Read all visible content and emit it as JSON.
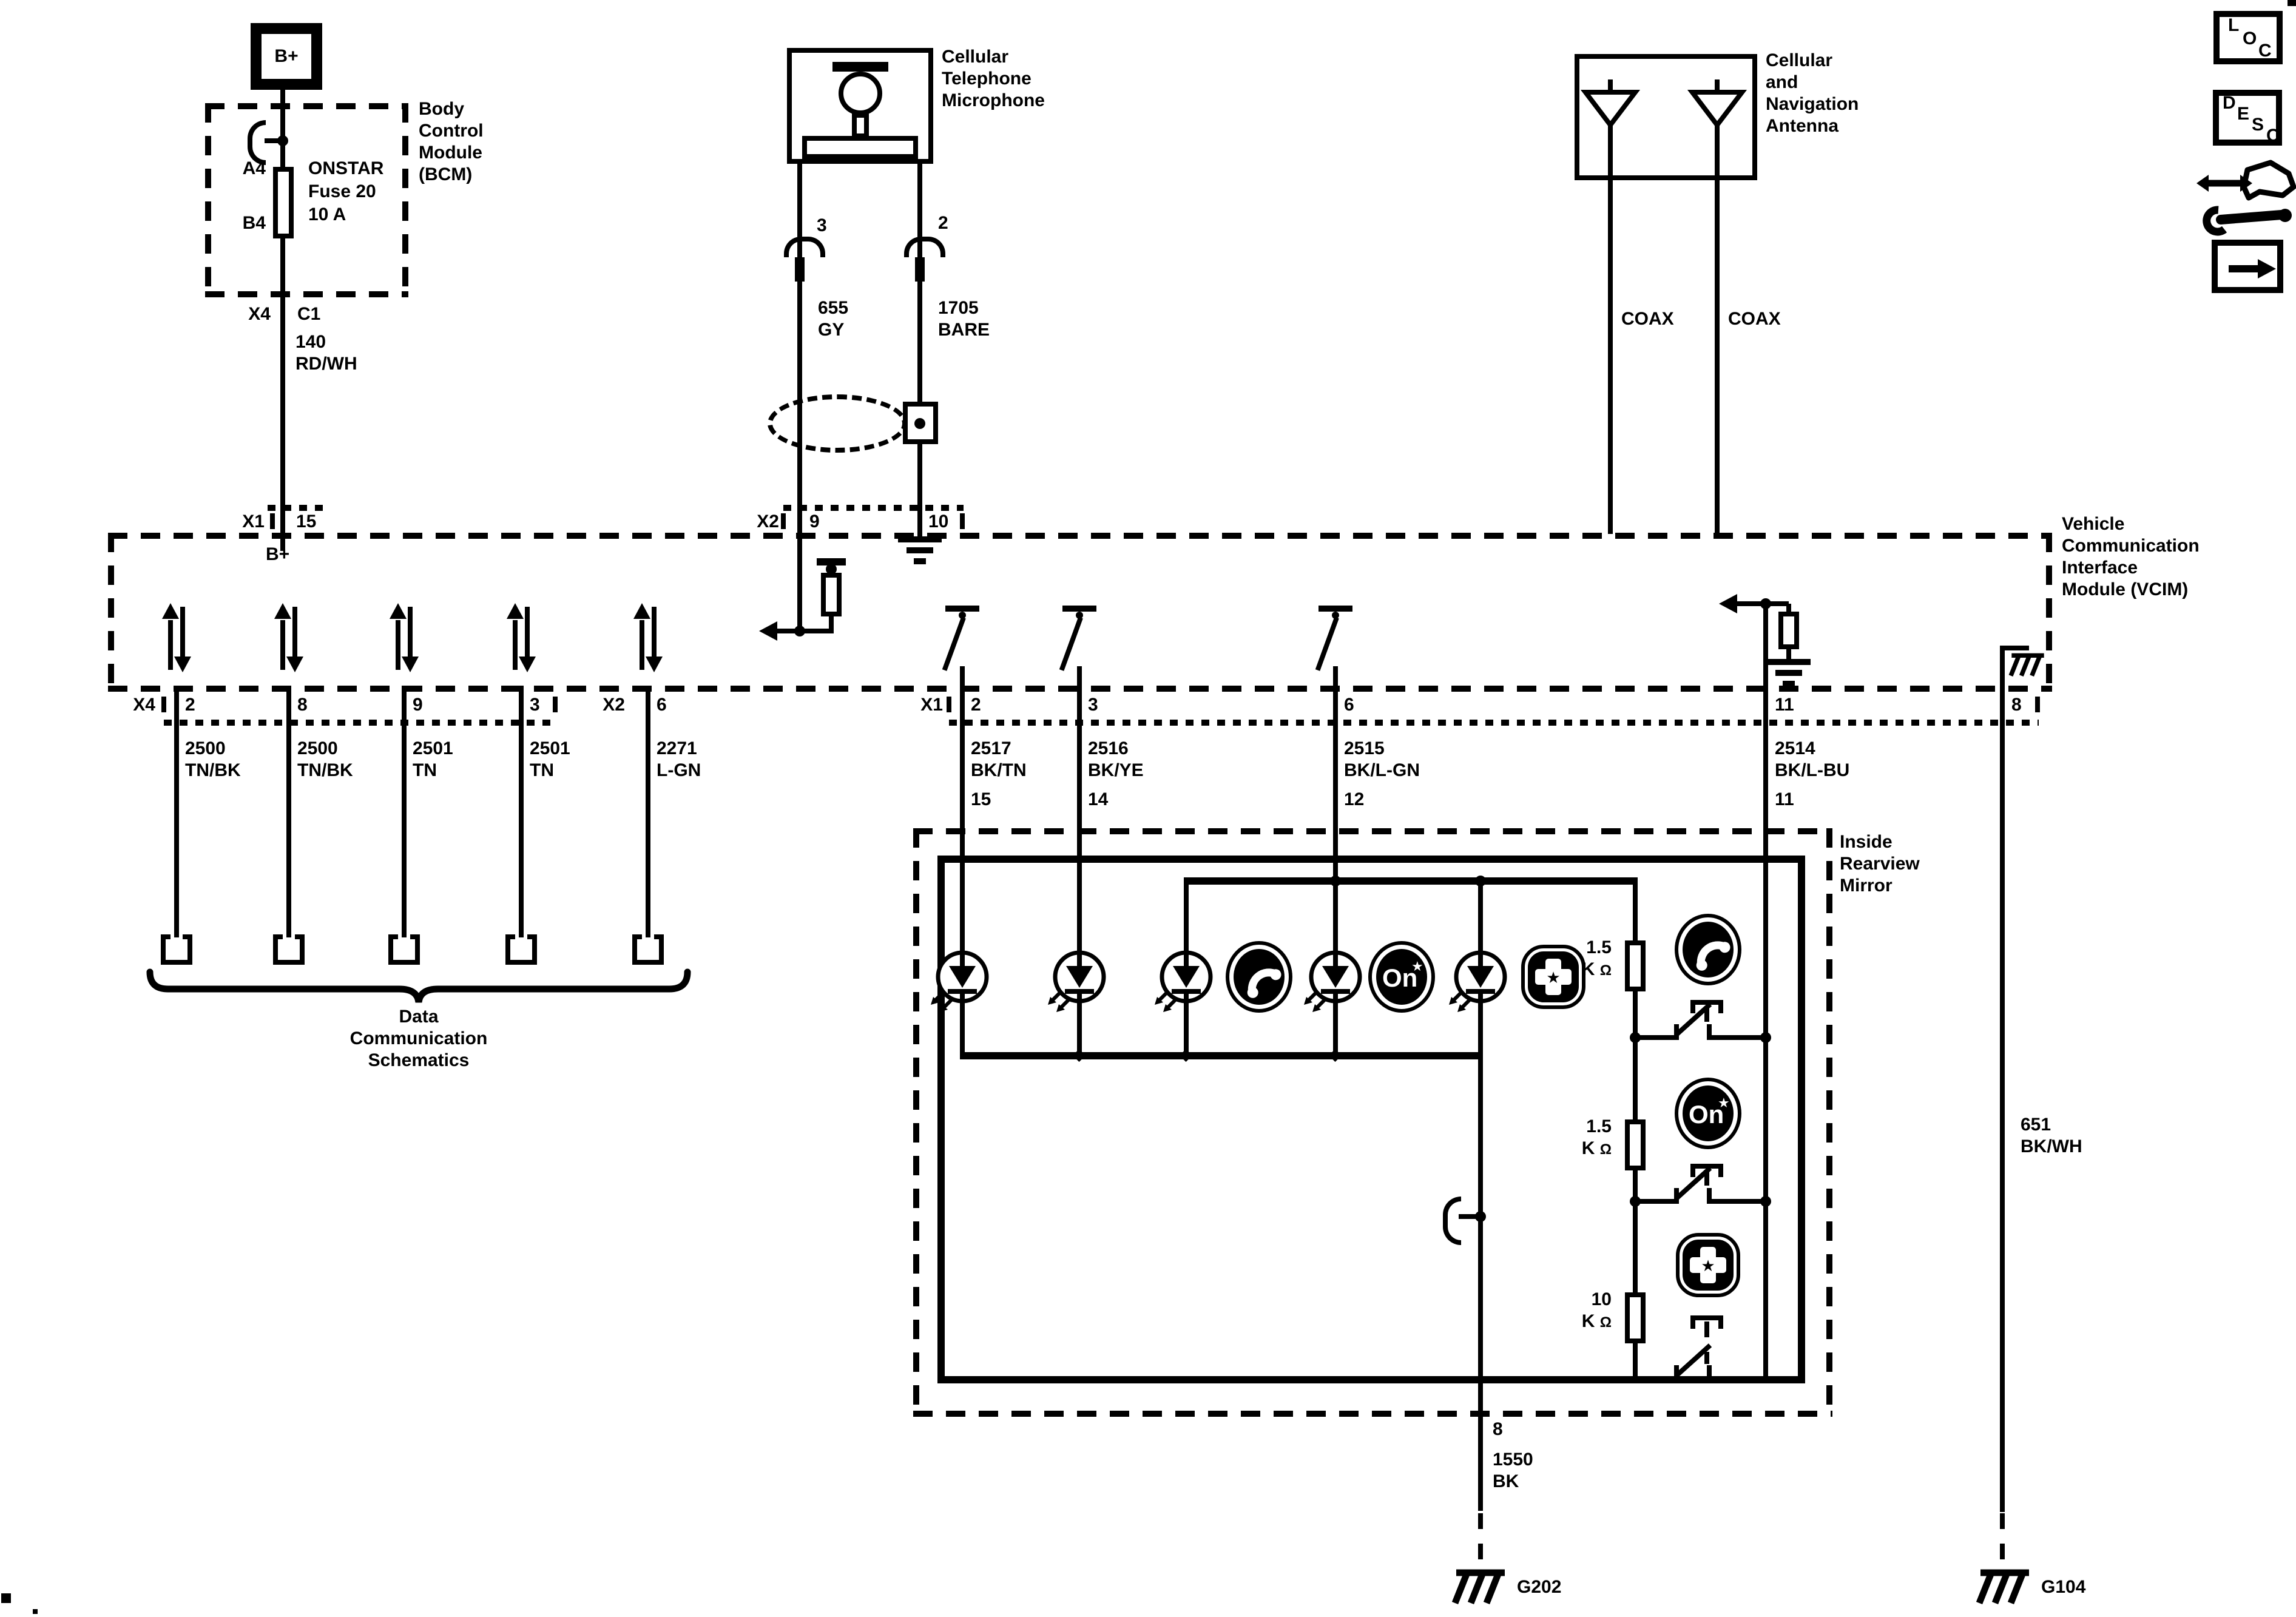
{
  "bcm": {
    "battery": "B+",
    "pin_a4": "A4",
    "pin_b4": "B4",
    "fuse_l1": "ONSTAR",
    "fuse_l2": "Fuse 20",
    "fuse_l3": "10 A",
    "name_l1": "Body",
    "name_l2": "Control",
    "name_l3": "Module",
    "name_l4": "(BCM)",
    "conn": "X4",
    "conn_pin": "C1"
  },
  "wire_140": {
    "num": "140",
    "color": "RD/WH",
    "vcim_conn": "X1",
    "vcim_pin": "15",
    "internal": "B+"
  },
  "mic": {
    "name_l1": "Cellular",
    "name_l2": "Telephone",
    "name_l3": "Microphone",
    "pin_left": "3",
    "pin_right": "2",
    "left_num": "655",
    "left_color": "GY",
    "right_num": "1705",
    "right_color": "BARE",
    "conn": "X2",
    "conn_pin_left": "9",
    "conn_pin_right": "10"
  },
  "antenna": {
    "name_l1": "Cellular",
    "name_l2": "and",
    "name_l3": "Navigation",
    "name_l4": "Antenna",
    "coax_left": "COAX",
    "coax_right": "COAX"
  },
  "vcim": {
    "name_l1": "Vehicle",
    "name_l2": "Communication",
    "name_l3": "Interface",
    "name_l4": "Module (VCIM)"
  },
  "x4_block": {
    "conn": "X4",
    "pin1": "2",
    "pin2": "8",
    "pin3": "9",
    "pin4": "3",
    "x2_conn": "X2",
    "x2_pin": "6"
  },
  "data_wires": [
    {
      "num": "2500",
      "color": "TN/BK"
    },
    {
      "num": "2500",
      "color": "TN/BK"
    },
    {
      "num": "2501",
      "color": "TN"
    },
    {
      "num": "2501",
      "color": "TN"
    },
    {
      "num": "2271",
      "color": "L-GN"
    }
  ],
  "brace": {
    "l1": "Data",
    "l2": "Communication",
    "l3": "Schematics"
  },
  "x1_block": {
    "conn": "X1",
    "pin1": "2",
    "pin2": "3",
    "pin3": "6",
    "pin4": "11",
    "pin5": "8"
  },
  "mirror_wires": [
    {
      "num": "2517",
      "color": "BK/TN",
      "pin": "15"
    },
    {
      "num": "2516",
      "color": "BK/YE",
      "pin": "14"
    },
    {
      "num": "2515",
      "color": "BK/L-GN",
      "pin": "12"
    },
    {
      "num": "2514",
      "color": "BK/L-BU",
      "pin": "11"
    }
  ],
  "mirror": {
    "name_l1": "Inside",
    "name_l2": "Rearview",
    "name_l3": "Mirror",
    "r1_val": "1.5",
    "r1_unit": "K",
    "r2_val": "1.5",
    "r2_unit": "K",
    "r3_val": "10",
    "r3_unit": "K",
    "ohm": "Ω",
    "pin_out": "8",
    "out_num": "1550",
    "out_color": "BK",
    "ground": "G202"
  },
  "right_branch": {
    "pin": "8",
    "num": "651",
    "color": "BK/WH",
    "ground": "G104"
  },
  "onstar": {
    "text": "On",
    "star": "★"
  },
  "corner_icons": {
    "loc": [
      "L",
      "O",
      "C"
    ],
    "desc": [
      "D",
      "E",
      "S",
      "C"
    ]
  }
}
